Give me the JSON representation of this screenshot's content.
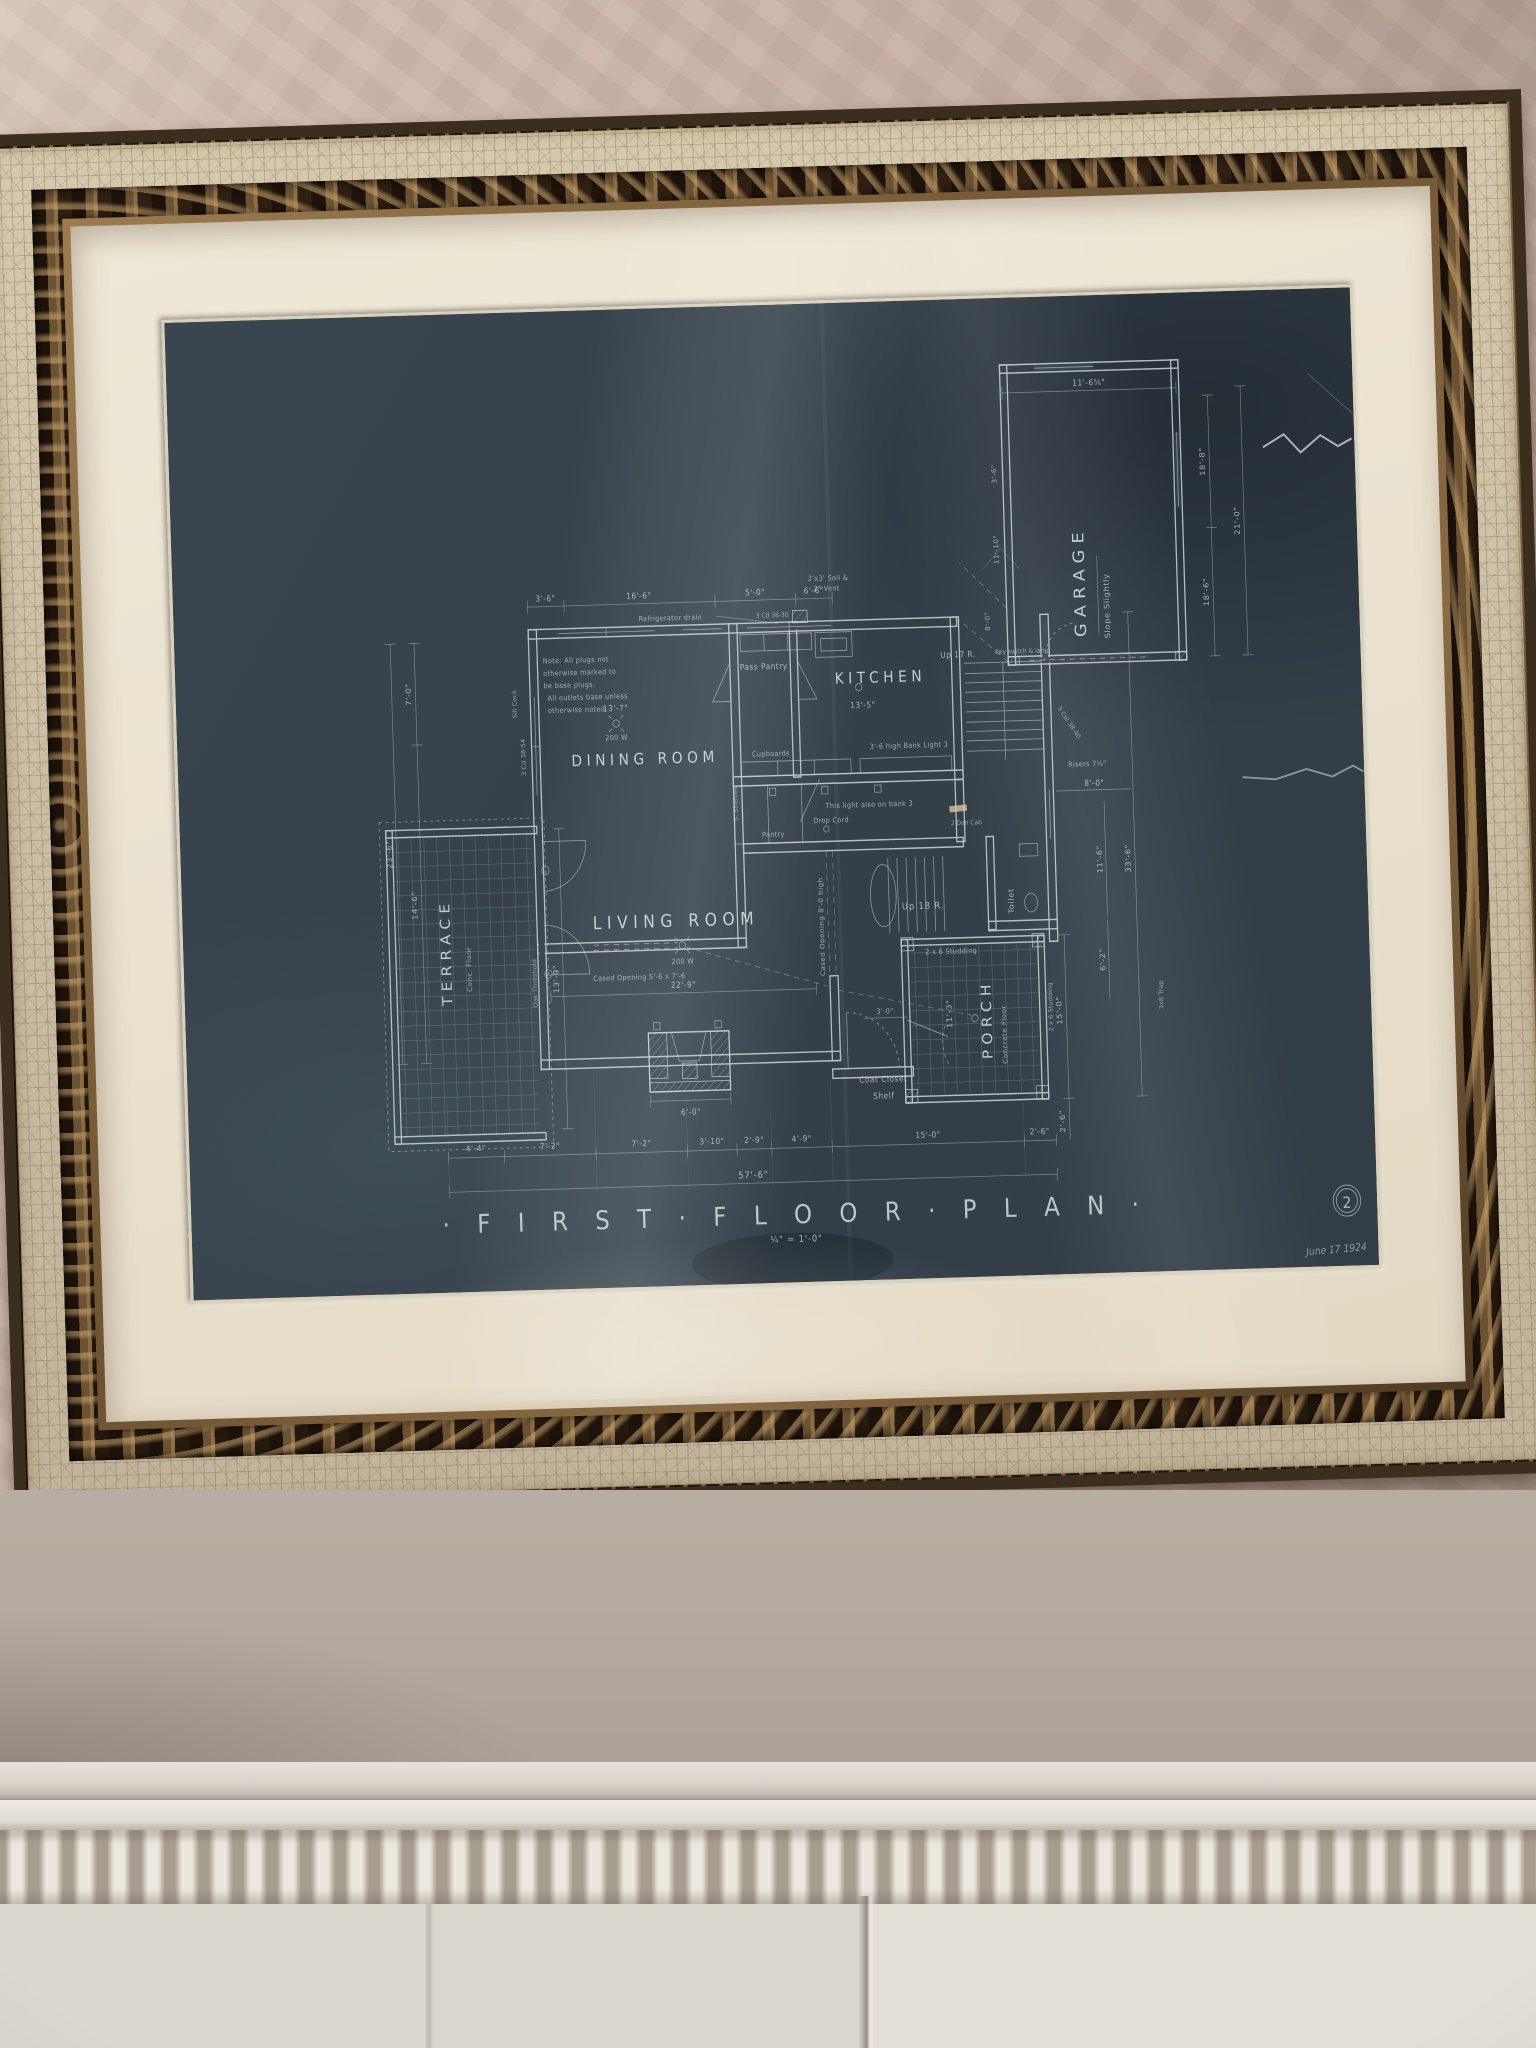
{
  "scene": {
    "description_colors": {
      "wall_plaster": "#cdb7aa",
      "frame_crackle": "#cdc0a6",
      "frame_bronze": "#6b5232",
      "mat": "#eae2cf",
      "blueprint_paper": "#35424b",
      "blueprint_ink": "#c5d1d5",
      "mantel_white": "#e0dbd3"
    }
  },
  "blueprint": {
    "title": "· F I R S T · F L O O R · P L A N ·",
    "scale": "¼\" = 1'-0\"",
    "sheet_number": "2",
    "date": "June 17 1924",
    "rooms": {
      "kitchen": "KITCHEN",
      "dining": "DINING ROOM",
      "living": "LIVING ROOM",
      "terrace": "TERRACE",
      "terrace_floor": "Conc. Floor",
      "porch": "PORCH",
      "porch_floor": "Concrete Floor",
      "garage": "GARAGE",
      "garage_note": "Slope Slightly",
      "pass_pantry": "Pass Pantry",
      "toilet": "Toilet",
      "pantry": "Pantry",
      "cupboards": "Cupboards",
      "coat_closet": "Coat Closet",
      "shelf": "Shelf"
    },
    "notes": {
      "note_line1": "Note: All plugs not",
      "note_line2": "otherwise marked to",
      "note_line3": "be base plugs.",
      "note_line4": "All outlets base unless",
      "note_line5": "otherwise noted",
      "refrigerator": "Refrigerator drain",
      "up17": "Up 17 R.",
      "up18": "Up 18 R.",
      "risers": "Risers 7¼\"",
      "bank_light": "3'-6 high Bank Light 3",
      "this_light": "This light also on bank 3",
      "drop_cord": "Drop Cord",
      "shelves_v": "S. Shelves",
      "cased_v": "Cased Opening 8'-0 high",
      "cased_h": "Cased Opening 5'-6 x 7'-6",
      "oak_threshold": "Oak Threshold",
      "sill_cock": "Sill Cock",
      "studding": "2 x 6 Studding",
      "soil1": "2'x3' Soil &",
      "soil2": "2\" Vent",
      "window_code_w": "3 Cd 38-54",
      "window_code_k": "3 Cd 38-30",
      "window_code_s": "3 Col 38-40",
      "den_cab": "2 Den Cab",
      "trap": "3x8 Trap",
      "switch_lamp": "Key switch & lamp",
      "w200": "200 W"
    },
    "dimensions": {
      "top": [
        "3'-6\"",
        "16'-6\"",
        "5'-0\"",
        "6'-6\""
      ],
      "garage_top": "11'-6⅝\"",
      "garage_right": [
        "18'-8\"",
        "21'-0\"",
        "18'-6\""
      ],
      "garage_left": [
        "3'-6\"",
        "11'-10\"",
        "8'-0\""
      ],
      "left": [
        "7'-0\"",
        "23'-6\"",
        "14'-6\"",
        "13'-9\""
      ],
      "bottom": [
        "4'-4\"",
        "7'-2\"",
        "7'-2\"",
        "3'-10\"",
        "2'-9\"",
        "4'-9\"",
        "15'-0\"",
        "2'-6\""
      ],
      "bottom_total": "57'-6\"",
      "right": [
        "8'-0\"",
        "11'-6\"",
        "6'-2\"",
        "33'-6\"",
        "15'-0\"",
        "2'-6\""
      ],
      "kitchen": "13'-5\"",
      "dining": "13'-7\"",
      "living_width": "22'-9\"",
      "fireplace": "6'-0\"",
      "porch_side": "11'-3\"",
      "stair_hall": "3'-0\""
    }
  }
}
